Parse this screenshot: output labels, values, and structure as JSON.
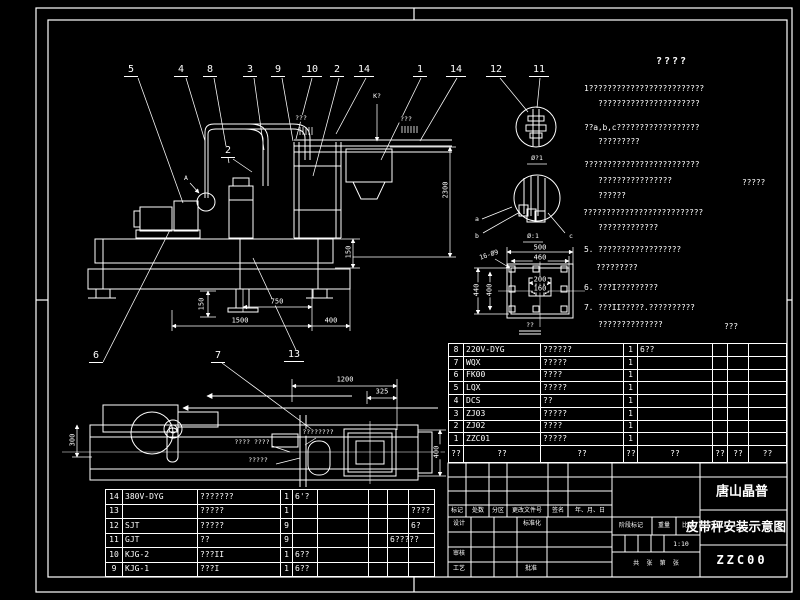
{
  "meta": {
    "background": "#000000",
    "line_color": "#ffffff"
  },
  "notes": {
    "title": "????",
    "lines": [
      {
        "x": 584,
        "y": 89,
        "t": "1?????????????????????????"
      },
      {
        "x": 598,
        "y": 104,
        "t": "??????????????????????"
      },
      {
        "x": 584,
        "y": 128,
        "t": "??a,b,c??????????????????"
      },
      {
        "x": 598,
        "y": 142,
        "t": "?????????"
      },
      {
        "x": 584,
        "y": 165,
        "t": "?????????????????????????"
      },
      {
        "x": 598,
        "y": 181,
        "t": "????????????????"
      },
      {
        "x": 742,
        "y": 183,
        "t": "?????"
      },
      {
        "x": 598,
        "y": 196,
        "t": "??????"
      },
      {
        "x": 583,
        "y": 213,
        "t": "??????????????????????????"
      },
      {
        "x": 598,
        "y": 228,
        "t": "?????????????"
      },
      {
        "x": 584,
        "y": 250,
        "t": "5. ??????????????????"
      },
      {
        "x": 596,
        "y": 268,
        "t": "?????????"
      },
      {
        "x": 584,
        "y": 288,
        "t": "6. ???I?????????"
      },
      {
        "x": 584,
        "y": 308,
        "t": "7. ???II?????.??????????"
      },
      {
        "x": 598,
        "y": 325,
        "t": "??????????????"
      },
      {
        "x": 724,
        "y": 327,
        "t": "???"
      }
    ]
  },
  "balloons": [
    {
      "x": 131,
      "y": 71,
      "t": "5"
    },
    {
      "x": 181,
      "y": 71,
      "t": "4"
    },
    {
      "x": 210,
      "y": 71,
      "t": "8"
    },
    {
      "x": 250,
      "y": 71,
      "t": "3"
    },
    {
      "x": 278,
      "y": 71,
      "t": "9"
    },
    {
      "x": 312,
      "y": 71,
      "t": "10"
    },
    {
      "x": 337,
      "y": 71,
      "t": "2"
    },
    {
      "x": 364,
      "y": 71,
      "t": "14"
    },
    {
      "x": 420,
      "y": 71,
      "t": "1"
    },
    {
      "x": 456,
      "y": 71,
      "t": "14"
    },
    {
      "x": 496,
      "y": 71,
      "t": "12"
    },
    {
      "x": 539,
      "y": 71,
      "t": "11"
    },
    {
      "x": 228,
      "y": 152,
      "t": "2"
    },
    {
      "x": 96,
      "y": 357,
      "t": "6"
    },
    {
      "x": 218,
      "y": 357,
      "t": "7"
    },
    {
      "x": 294,
      "y": 356,
      "t": "13"
    }
  ],
  "dims": [
    {
      "x": 446,
      "y": 190,
      "t": "2300",
      "r": -90
    },
    {
      "x": 349,
      "y": 252,
      "t": "150",
      "r": -90
    },
    {
      "x": 202,
      "y": 304,
      "t": "150",
      "r": -90
    },
    {
      "x": 277,
      "y": 302,
      "t": "750"
    },
    {
      "x": 240,
      "y": 321,
      "t": "1500"
    },
    {
      "x": 331,
      "y": 321,
      "t": "400"
    },
    {
      "x": 345,
      "y": 380,
      "t": "1200"
    },
    {
      "x": 382,
      "y": 392,
      "t": "325"
    },
    {
      "x": 437,
      "y": 452,
      "t": "400",
      "r": -90
    },
    {
      "x": 73,
      "y": 440,
      "t": "300",
      "r": -90
    },
    {
      "x": 540,
      "y": 248,
      "t": "500"
    },
    {
      "x": 540,
      "y": 258,
      "t": "460"
    },
    {
      "x": 477,
      "y": 290,
      "t": "440",
      "r": -90
    },
    {
      "x": 490,
      "y": 290,
      "t": "400",
      "r": -90
    },
    {
      "x": 540,
      "y": 280,
      "t": "200"
    },
    {
      "x": 540,
      "y": 289,
      "t": "160"
    }
  ],
  "annots": [
    {
      "x": 301,
      "y": 118,
      "t": "???"
    },
    {
      "x": 406,
      "y": 119,
      "t": "???"
    },
    {
      "x": 377,
      "y": 96,
      "t": "K?"
    },
    {
      "x": 186,
      "y": 178,
      "t": "A"
    },
    {
      "x": 318,
      "y": 432,
      "t": "????????"
    },
    {
      "x": 252,
      "y": 442,
      "t": "???? ????"
    },
    {
      "x": 258,
      "y": 460,
      "t": "?????"
    },
    {
      "x": 489,
      "y": 255,
      "t": "16-Ø9",
      "r": -18
    },
    {
      "x": 537,
      "y": 158,
      "t": "Ø?1"
    },
    {
      "x": 533,
      "y": 236,
      "t": "Ø:1"
    },
    {
      "x": 477,
      "y": 219,
      "t": "a"
    },
    {
      "x": 477,
      "y": 236,
      "t": "b"
    },
    {
      "x": 571,
      "y": 236,
      "t": "c"
    },
    {
      "x": 530,
      "y": 325,
      "t": "??"
    }
  ],
  "parts_upper": {
    "rows": [
      {
        "no": "8",
        "code": "220V-DYG",
        "name": "??????",
        "qty": "1",
        "rem": "6??",
        "c6": "",
        "c7": "",
        "c8": ""
      },
      {
        "no": "7",
        "code": "WQX",
        "name": "?????",
        "qty": "1",
        "rem": "",
        "c6": "",
        "c7": "",
        "c8": ""
      },
      {
        "no": "6",
        "code": "FK00",
        "name": "????",
        "qty": "1",
        "rem": "",
        "c6": "",
        "c7": "",
        "c8": ""
      },
      {
        "no": "5",
        "code": "LQX",
        "name": "?????",
        "qty": "1",
        "rem": "",
        "c6": "",
        "c7": "",
        "c8": ""
      },
      {
        "no": "4",
        "code": "DCS",
        "name": "??",
        "qty": "1",
        "rem": "",
        "c6": "",
        "c7": "",
        "c8": ""
      },
      {
        "no": "3",
        "code": "ZJ03",
        "name": "?????",
        "qty": "1",
        "rem": "",
        "c6": "",
        "c7": "",
        "c8": ""
      },
      {
        "no": "2",
        "code": "ZJ02",
        "name": "????",
        "qty": "1",
        "rem": "",
        "c6": "",
        "c7": "",
        "c8": ""
      },
      {
        "no": "1",
        "code": "ZZC01",
        "name": "?????",
        "qty": "1",
        "rem": "",
        "c6": "",
        "c7": "",
        "c8": ""
      }
    ],
    "footer": [
      {
        "t": "??"
      },
      {
        "t": "??"
      },
      {
        "t": "??"
      },
      {
        "t": "??"
      },
      {
        "t": "??"
      },
      {
        "t": "??"
      },
      {
        "t": "??"
      },
      {
        "t": "??"
      }
    ]
  },
  "parts_lower": {
    "rows": [
      {
        "no": "14",
        "code": "380V-DYG",
        "name": "???????",
        "qty": "1",
        "rem": "6'?",
        "c6": "",
        "c7": "",
        "c8": "",
        "c9": ""
      },
      {
        "no": "13",
        "code": "",
        "name": "?????",
        "qty": "1",
        "rem": "",
        "c6": "",
        "c7": "",
        "c8": "",
        "c9": "????"
      },
      {
        "no": "12",
        "code": "SJT",
        "name": "?????",
        "qty": "9",
        "rem": "",
        "c6": "",
        "c7": "",
        "c8": "",
        "c9": "6?"
      },
      {
        "no": "11",
        "code": "GJT",
        "name": "??",
        "qty": "9",
        "rem": "",
        "c6": "",
        "c7": "",
        "c8": "6?????",
        "c9": ""
      },
      {
        "no": "10",
        "code": "KJG-2",
        "name": "???II",
        "qty": "1",
        "rem": "6??",
        "c6": "",
        "c7": "",
        "c8": "",
        "c9": ""
      },
      {
        "no": "9",
        "code": "KJG-1",
        "name": "???I",
        "qty": "1",
        "rem": "6??",
        "c6": "",
        "c7": "",
        "c8": "",
        "c9": ""
      }
    ]
  },
  "titleblock": {
    "company": "唐山晶普",
    "drawing_title": "皮带秤安装示意图",
    "drawing_number": "ZZC00",
    "scale": "1:10",
    "labels": [
      {
        "x": 457,
        "y": 511,
        "t": "标记"
      },
      {
        "x": 478,
        "y": 511,
        "t": "处数"
      },
      {
        "x": 498,
        "y": 511,
        "t": "分区"
      },
      {
        "x": 527,
        "y": 511,
        "t": "更改文件号"
      },
      {
        "x": 558,
        "y": 511,
        "t": "签名"
      },
      {
        "x": 590,
        "y": 511,
        "t": "年、月、日"
      },
      {
        "x": 459,
        "y": 524,
        "t": "设计"
      },
      {
        "x": 532,
        "y": 524,
        "t": "标准化"
      },
      {
        "x": 459,
        "y": 554,
        "t": "审核"
      },
      {
        "x": 459,
        "y": 569,
        "t": "工艺"
      },
      {
        "x": 531,
        "y": 569,
        "t": "批准"
      },
      {
        "x": 631,
        "y": 526,
        "t": "阶段标记"
      },
      {
        "x": 664,
        "y": 526,
        "t": "重量"
      },
      {
        "x": 688,
        "y": 526,
        "t": "比例"
      },
      {
        "x": 656,
        "y": 564,
        "t": "共  张  第  张"
      }
    ]
  }
}
